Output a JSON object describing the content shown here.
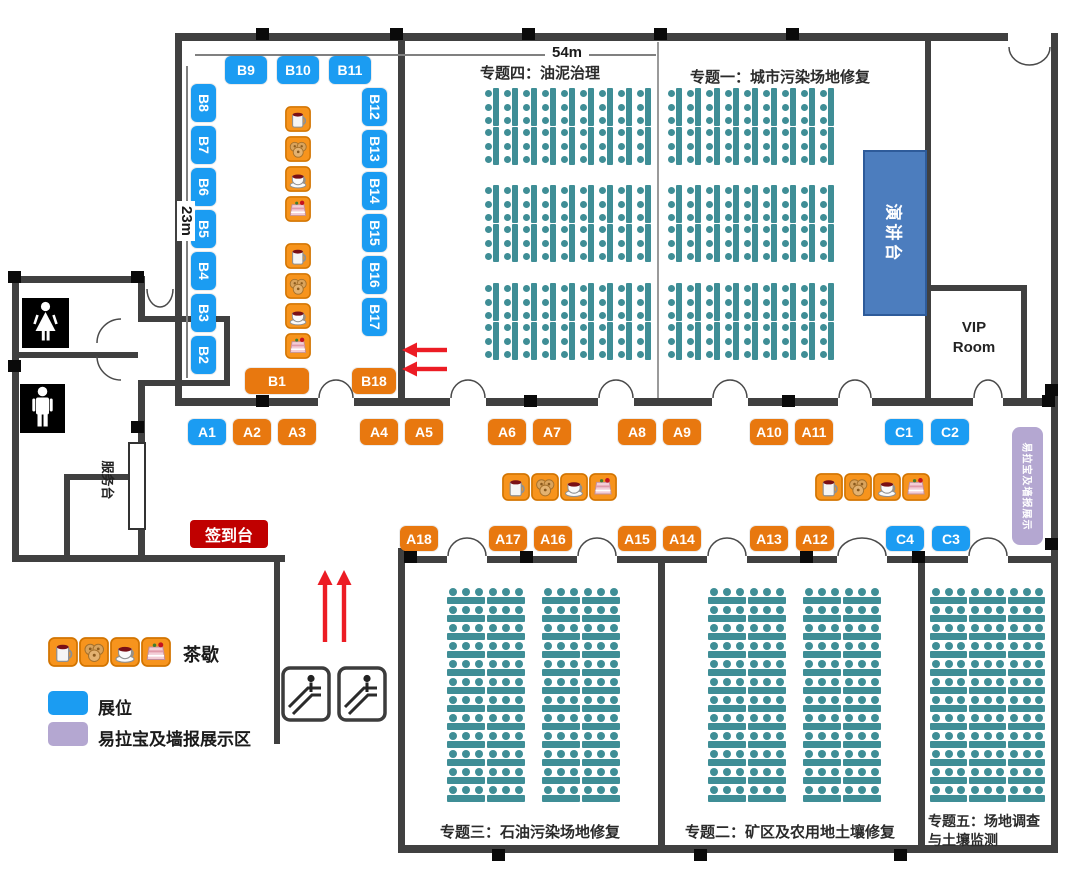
{
  "dimensions": {
    "width": "54m",
    "height": "23m"
  },
  "topics": {
    "one": "专题一：城市污染场地修复",
    "two": "专题二：矿区及农用地土壤修复",
    "three": "专题三：石油污染场地修复",
    "four": "专题四：油泥治理",
    "five_line1": "专题五：场地调查",
    "five_line2": "与土壤监测"
  },
  "rooms": {
    "vip_line1": "VIP",
    "vip_line2": "Room",
    "podium": "演讲台",
    "service_desk": "服务台",
    "checkin": "签到台"
  },
  "legend": {
    "tea_break": "茶歇",
    "booth": "展位",
    "banner_area": "易拉宝及墙报展示区"
  },
  "banner_vertical": "易拉宝及墙报展示",
  "booths": {
    "a_row_upper": [
      {
        "id": "A1",
        "variant": "blue"
      },
      {
        "id": "A2",
        "variant": "orange"
      },
      {
        "id": "A3",
        "variant": "orange"
      },
      {
        "id": "A4",
        "variant": "orange"
      },
      {
        "id": "A5",
        "variant": "orange"
      },
      {
        "id": "A6",
        "variant": "orange"
      },
      {
        "id": "A7",
        "variant": "orange"
      },
      {
        "id": "A8",
        "variant": "orange"
      },
      {
        "id": "A9",
        "variant": "orange"
      },
      {
        "id": "A10",
        "variant": "orange"
      },
      {
        "id": "A11",
        "variant": "orange"
      },
      {
        "id": "C1",
        "variant": "blue"
      },
      {
        "id": "C2",
        "variant": "blue"
      }
    ],
    "a_row_lower": [
      {
        "id": "A18",
        "variant": "orange"
      },
      {
        "id": "A17",
        "variant": "orange"
      },
      {
        "id": "A16",
        "variant": "orange"
      },
      {
        "id": "A15",
        "variant": "orange"
      },
      {
        "id": "A14",
        "variant": "orange"
      },
      {
        "id": "A13",
        "variant": "orange"
      },
      {
        "id": "A12",
        "variant": "orange"
      },
      {
        "id": "C4",
        "variant": "blue"
      },
      {
        "id": "C3",
        "variant": "blue"
      }
    ],
    "b_top": [
      "B9",
      "B10",
      "B11"
    ],
    "b_left": [
      "B8",
      "B7",
      "B6",
      "B5",
      "B4",
      "B3",
      "B2"
    ],
    "b_right": [
      "B12",
      "B13",
      "B14",
      "B15",
      "B16",
      "B17"
    ],
    "b_wide": [
      "B1",
      "B18"
    ]
  },
  "icons": {
    "tea_set": [
      "mug-icon",
      "cream-puff-icon",
      "coffee-cup-icon",
      "cake-icon"
    ],
    "escalator": "escalator-icon",
    "female": "female-icon",
    "male": "male-icon",
    "arrow_up": "red-arrow-up-icon",
    "arrow_left": "red-arrow-left-icon"
  },
  "seating": {
    "top_hall": {
      "blocks": 3,
      "rows_per_block": 2,
      "tables_per_half_row": 9,
      "seats_per_table": 3
    },
    "bottom_rooms": {
      "rows": 12,
      "seats_per_table": 3
    }
  },
  "colors": {
    "booth_blue": "#1B9CF2",
    "booth_orange": "#E8780F",
    "checkin_red": "#C00000",
    "seat_teal": "#3F8E96",
    "banner_lavender": "#B4A7D1",
    "podium_blue": "#4C7DBE",
    "wall": "#404040",
    "arrow_red": "#EC1C24"
  }
}
